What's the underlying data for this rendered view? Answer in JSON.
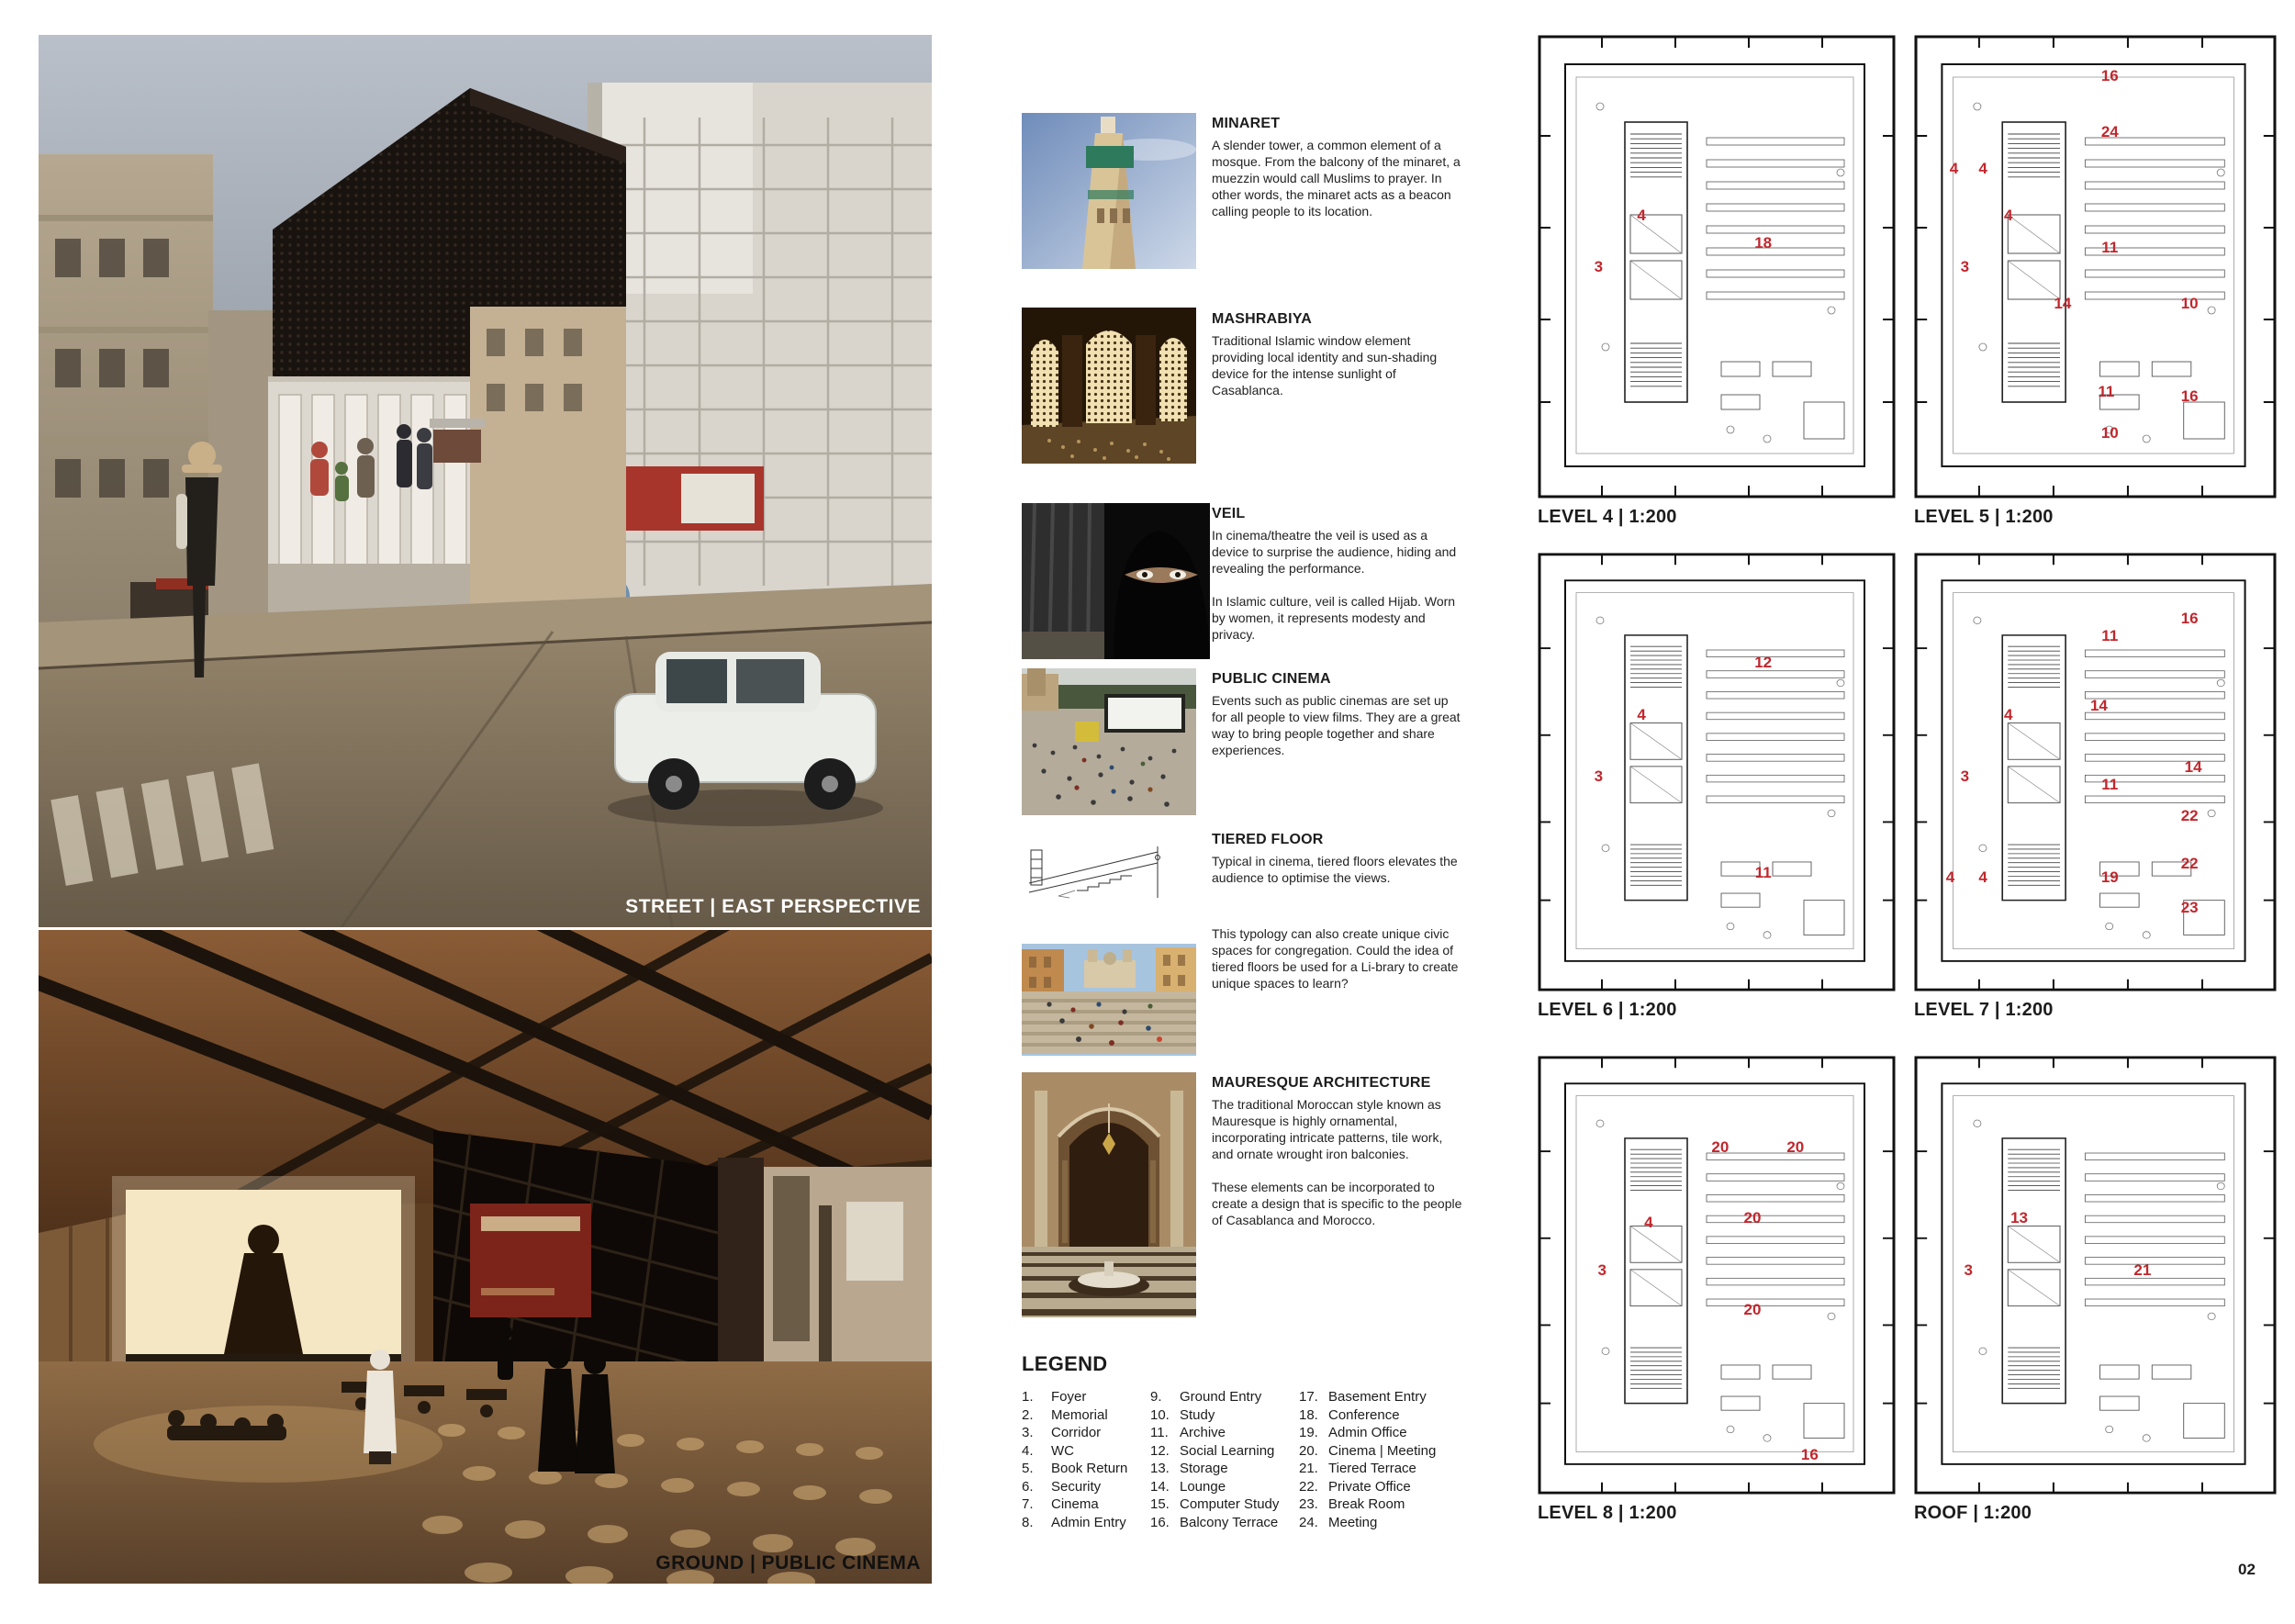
{
  "page_number": "02",
  "accent_red": "#c1272d",
  "renders": {
    "street": {
      "caption": "STREET | EAST PERSPECTIVE"
    },
    "ground": {
      "caption": "GROUND | PUBLIC CINEMA"
    }
  },
  "concepts": [
    {
      "image": "minaret-photo",
      "title": "MINARET",
      "body": "A slender tower, a common element of a mosque. From the balcony of the minaret, a muezzin would call Muslims to prayer. In other words, the minaret acts as a beacon calling people to its location."
    },
    {
      "image": "mashrabiya-photo",
      "title": "MASHRABIYA",
      "body": "Traditional Islamic window element providing local identity and sun-shading device for the intense sunlight of Casablanca."
    },
    {
      "image": "veil-photo",
      "title": "VEIL",
      "body": "In cinema/theatre the veil is used as a device to surprise the audience, hiding and revealing the performance.",
      "body2": "In Islamic culture, veil is called Hijab. Worn by women, it represents modesty and privacy."
    },
    {
      "image": "public-cinema-photo",
      "title": "PUBLIC CINEMA",
      "body": "Events such as public cinemas are set up for all people to view films. They are a great way to bring people together and share experiences."
    },
    {
      "image": "tiered-floor-diagram",
      "title": "TIERED FLOOR",
      "body": "Typical in cinema, tiered floors elevates the audience to optimise the views."
    },
    {
      "image": "spanish-steps-photo",
      "title": "",
      "body": "This typology can also create unique civic spaces for congregation. Could the idea of tiered floors be used for a Li-brary to create unique spaces to learn?"
    },
    {
      "image": "mauresque-photo",
      "title": "MAURESQUE ARCHITECTURE",
      "body": "The traditional Moroccan style known as Mauresque is highly ornamental, incorporating intricate patterns, tile work, and ornate wrought iron balconies.",
      "body2": "These elements can be incorporated to create a design that is specific to the people of Casablanca and Morocco."
    }
  ],
  "legend": {
    "title": "LEGEND",
    "items": [
      {
        "n": "1.",
        "label": "Foyer"
      },
      {
        "n": "2.",
        "label": "Memorial"
      },
      {
        "n": "3.",
        "label": "Corridor"
      },
      {
        "n": "4.",
        "label": "WC"
      },
      {
        "n": "5.",
        "label": "Book Return"
      },
      {
        "n": "6.",
        "label": "Security"
      },
      {
        "n": "7.",
        "label": "Cinema"
      },
      {
        "n": "8.",
        "label": "Admin Entry"
      },
      {
        "n": "9.",
        "label": "Ground Entry"
      },
      {
        "n": "10.",
        "label": "Study"
      },
      {
        "n": "11.",
        "label": "Archive"
      },
      {
        "n": "12.",
        "label": "Social Learning"
      },
      {
        "n": "13.",
        "label": "Storage"
      },
      {
        "n": "14.",
        "label": "Lounge"
      },
      {
        "n": "15.",
        "label": "Computer Study"
      },
      {
        "n": "16.",
        "label": "Balcony Terrace"
      },
      {
        "n": "17.",
        "label": "Basement Entry"
      },
      {
        "n": "18.",
        "label": "Conference"
      },
      {
        "n": "19.",
        "label": "Admin Office"
      },
      {
        "n": "20.",
        "label": "Cinema | Meeting"
      },
      {
        "n": "21.",
        "label": "Tiered Terrace"
      },
      {
        "n": "22.",
        "label": "Private Office"
      },
      {
        "n": "23.",
        "label": "Break Room"
      },
      {
        "n": "24.",
        "label": "Meeting"
      }
    ]
  },
  "plans": [
    {
      "label": "LEVEL 4 | 1:200",
      "rooms": [
        {
          "n": "4",
          "x": 29,
          "y": 39
        },
        {
          "n": "3",
          "x": 17,
          "y": 50
        },
        {
          "n": "18",
          "x": 63,
          "y": 45
        }
      ]
    },
    {
      "label": "LEVEL 5 | 1:200",
      "rooms": [
        {
          "n": "16",
          "x": 54,
          "y": 9
        },
        {
          "n": "4",
          "x": 11,
          "y": 29
        },
        {
          "n": "4",
          "x": 19,
          "y": 29
        },
        {
          "n": "24",
          "x": 54,
          "y": 21
        },
        {
          "n": "4",
          "x": 26,
          "y": 39
        },
        {
          "n": "3",
          "x": 14,
          "y": 50
        },
        {
          "n": "11",
          "x": 54,
          "y": 46
        },
        {
          "n": "14",
          "x": 41,
          "y": 58
        },
        {
          "n": "10",
          "x": 76,
          "y": 58
        },
        {
          "n": "11",
          "x": 53,
          "y": 77
        },
        {
          "n": "16",
          "x": 76,
          "y": 78
        },
        {
          "n": "10",
          "x": 54,
          "y": 86
        }
      ]
    },
    {
      "label": "LEVEL 6 | 1:200",
      "rooms": [
        {
          "n": "12",
          "x": 63,
          "y": 25
        },
        {
          "n": "4",
          "x": 29,
          "y": 37
        },
        {
          "n": "3",
          "x": 17,
          "y": 51
        },
        {
          "n": "11",
          "x": 63,
          "y": 73
        }
      ]
    },
    {
      "label": "LEVEL 7 | 1:200",
      "rooms": [
        {
          "n": "16",
          "x": 76,
          "y": 15
        },
        {
          "n": "11",
          "x": 54,
          "y": 19
        },
        {
          "n": "14",
          "x": 51,
          "y": 35
        },
        {
          "n": "4",
          "x": 26,
          "y": 37
        },
        {
          "n": "3",
          "x": 14,
          "y": 51
        },
        {
          "n": "14",
          "x": 77,
          "y": 49
        },
        {
          "n": "11",
          "x": 54,
          "y": 53
        },
        {
          "n": "22",
          "x": 76,
          "y": 60
        },
        {
          "n": "22",
          "x": 76,
          "y": 71
        },
        {
          "n": "4",
          "x": 10,
          "y": 74
        },
        {
          "n": "4",
          "x": 19,
          "y": 74
        },
        {
          "n": "19",
          "x": 54,
          "y": 74
        },
        {
          "n": "23",
          "x": 76,
          "y": 81
        }
      ]
    },
    {
      "label": "LEVEL 8 | 1:200",
      "rooms": [
        {
          "n": "20",
          "x": 51,
          "y": 21
        },
        {
          "n": "20",
          "x": 72,
          "y": 21
        },
        {
          "n": "4",
          "x": 31,
          "y": 38
        },
        {
          "n": "20",
          "x": 60,
          "y": 37
        },
        {
          "n": "3",
          "x": 18,
          "y": 49
        },
        {
          "n": "20",
          "x": 60,
          "y": 58
        },
        {
          "n": "16",
          "x": 76,
          "y": 91
        }
      ]
    },
    {
      "label": "ROOF | 1:200",
      "rooms": [
        {
          "n": "13",
          "x": 29,
          "y": 37
        },
        {
          "n": "3",
          "x": 15,
          "y": 49
        },
        {
          "n": "21",
          "x": 63,
          "y": 49
        }
      ]
    }
  ]
}
